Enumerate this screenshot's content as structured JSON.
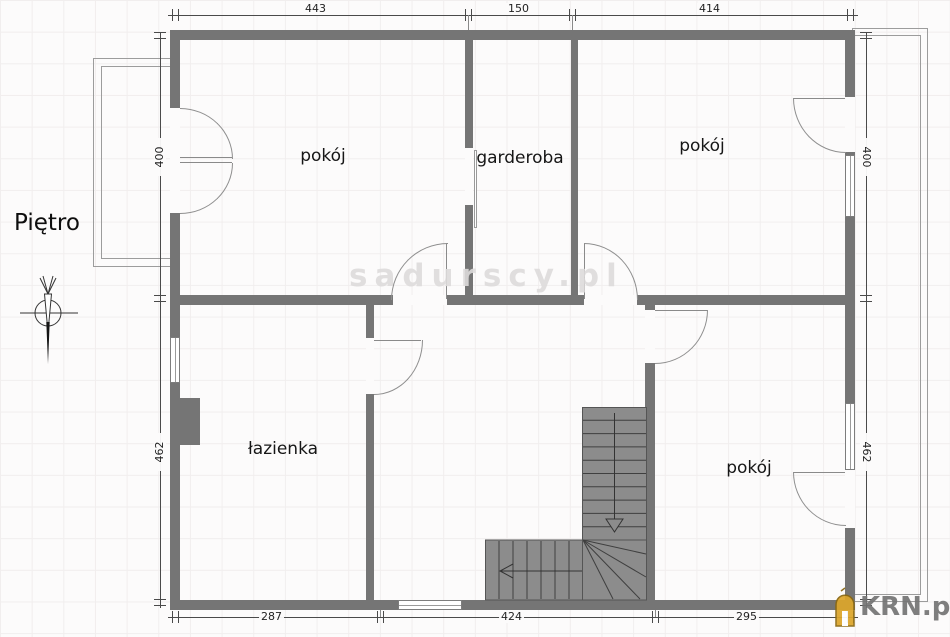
{
  "floor_label": "Piętro",
  "watermark": "sadurscy.pl",
  "logo": {
    "text": "KRN.pl",
    "house_color": "#DCA62B",
    "text_color": "#757575"
  },
  "rooms": {
    "room_top_left": "pokój",
    "wardrobe": "garderoba",
    "room_top_right": "pokój",
    "bathroom": "łazienka",
    "room_bottom_right": "pokój"
  },
  "dimensions": {
    "top": [
      "443",
      "150",
      "414"
    ],
    "bottom": [
      "287",
      "424",
      "295"
    ],
    "left": [
      "400",
      "462"
    ],
    "right": [
      "400",
      "462"
    ]
  },
  "colors": {
    "wall": "#757575",
    "stairs": "#8C8C8C",
    "watermark_gray": "#DDDADA"
  }
}
